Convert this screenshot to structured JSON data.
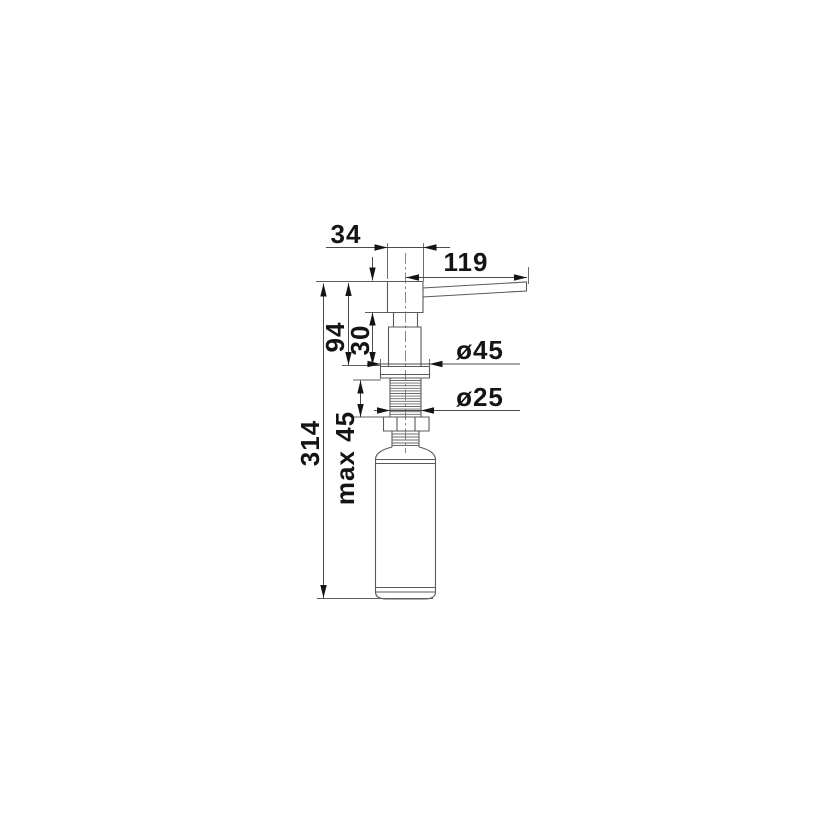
{
  "drawing": {
    "type": "technical-dimension-drawing",
    "subject": "soap-dispenser-front-view"
  },
  "colors": {
    "background": "#ffffff",
    "part_line": "#5a5a5a",
    "dimension_line": "#4a4a4a",
    "label_text": "#141414"
  },
  "dimensions": {
    "head_width": "34",
    "spout_reach": "119",
    "height_above_counter": "94",
    "lower_head_height": "30",
    "flange_diameter": "ø45",
    "shaft_diameter": "ø25",
    "max_counter_thickness": "max 45",
    "total_height": "314"
  }
}
